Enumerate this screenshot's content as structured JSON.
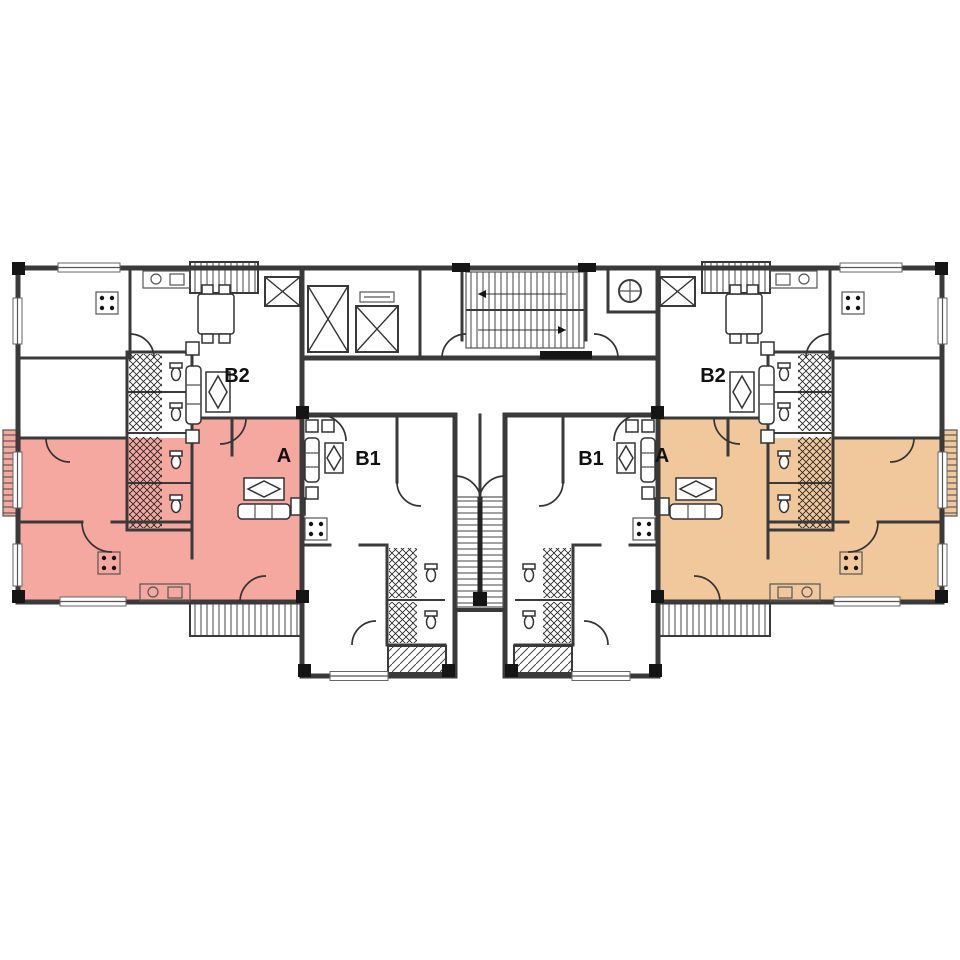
{
  "plan": {
    "type": "apartment-floor-plan",
    "units": [
      {
        "id": "b2-left",
        "label": "B2",
        "highlighted": false
      },
      {
        "id": "a-left",
        "label": "A",
        "highlighted": true,
        "highlight_color": "#f4a8a0"
      },
      {
        "id": "b1-left",
        "label": "B1",
        "highlighted": false
      },
      {
        "id": "b1-right",
        "label": "B1",
        "highlighted": false
      },
      {
        "id": "a-right",
        "label": "A",
        "highlighted": true,
        "highlight_color": "#f0c89c"
      },
      {
        "id": "b2-right",
        "label": "B2",
        "highlighted": false
      }
    ],
    "features": [
      "elevators",
      "main-staircase",
      "central-staircase",
      "fire-stairs",
      "balconies",
      "bathrooms"
    ]
  },
  "colors": {
    "unit_a_left": "#f4a8a0",
    "unit_a_right": "#f0c89c",
    "wall": "#3a3a3a",
    "label_text": "#111111",
    "background": "#ffffff"
  }
}
